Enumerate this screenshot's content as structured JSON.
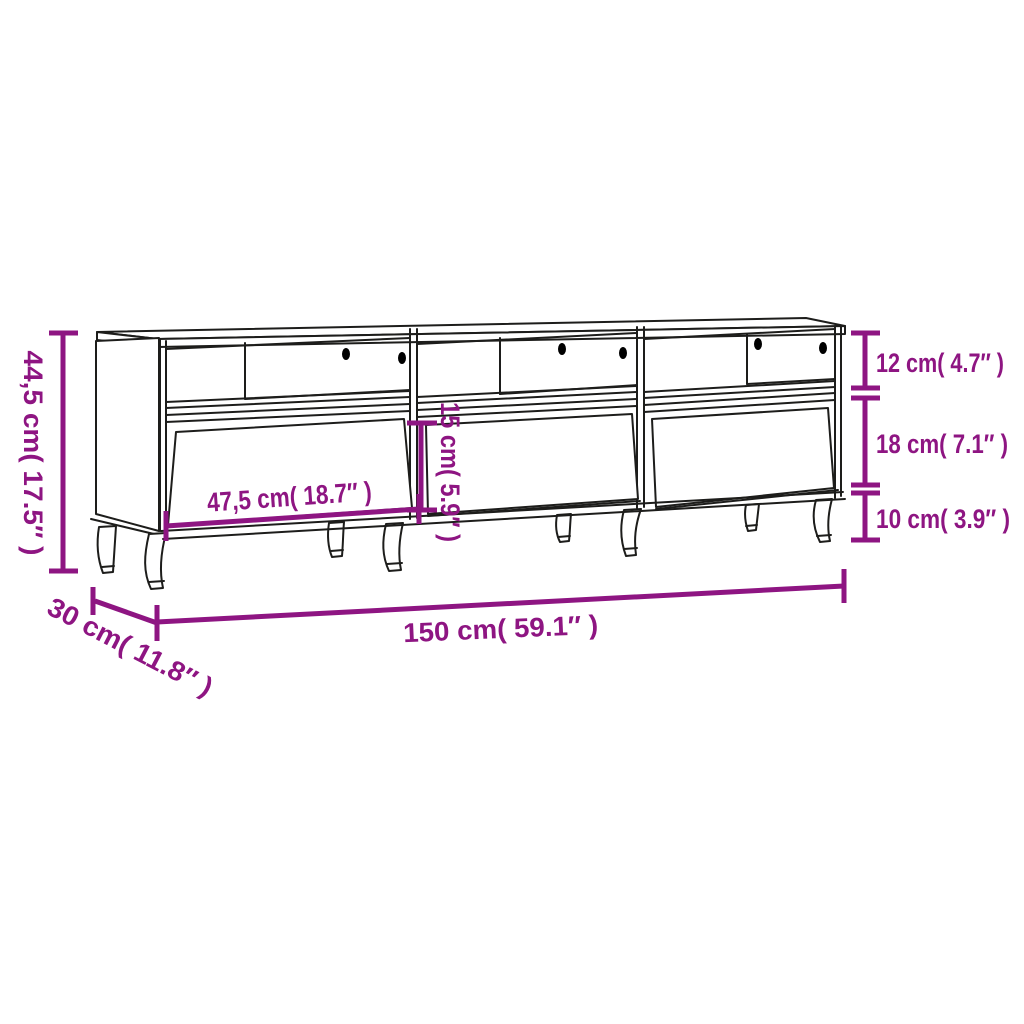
{
  "title": "TV cabinet dimension diagram",
  "colors": {
    "background": "#ffffff",
    "measure": "#8e1582",
    "line": "#1d1d1b",
    "hole": "#000000"
  },
  "product": {
    "type": "TV cabinet line drawing",
    "sections": 3,
    "drawers": 3,
    "legs": 8,
    "cable_holes_per_section": 2
  },
  "dimensions": {
    "height": {
      "label": "44,5 cm( 17.5″ )",
      "cm": "44,5",
      "inch": "17.5"
    },
    "depth": {
      "label": "30 cm( 11.8″ )",
      "cm": "30",
      "inch": "11.8"
    },
    "width": {
      "label": "150 cm( 59.1″ )",
      "cm": "150",
      "inch": "59.1"
    },
    "drawer_width": {
      "label": "47,5 cm( 18.7″ )",
      "cm": "47,5",
      "inch": "18.7"
    },
    "drawer_height": {
      "label": "15 cm( 5.9″ )",
      "cm": "15",
      "inch": "5.9"
    },
    "top_height": {
      "label": "12 cm( 4.7″ )",
      "cm": "12",
      "inch": "4.7"
    },
    "middle_height": {
      "label": "18 cm( 7.1″ )",
      "cm": "18",
      "inch": "7.1"
    },
    "leg_height": {
      "label": "10 cm( 3.9″ )",
      "cm": "10",
      "inch": "3.9"
    }
  }
}
